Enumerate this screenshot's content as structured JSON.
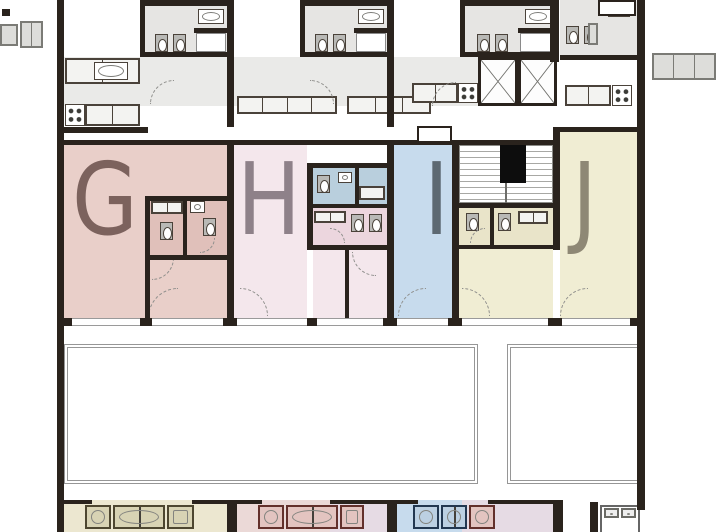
{
  "plan": {
    "kind": "apartment-floor-plan"
  },
  "units": [
    {
      "id": "g",
      "label": "G",
      "fill": "#e9cfc9",
      "bath_fill": "#e0c0ba",
      "letter_color": "#7c625d"
    },
    {
      "id": "h",
      "label": "H",
      "fill": "#f4e7ec",
      "bath_fill": "#ecd6de",
      "letter_color": "#8e8189"
    },
    {
      "id": "i",
      "label": "I",
      "fill": "#c7dbed",
      "bath_fill": "#b9cfdd",
      "letter_color": "#5d6972"
    },
    {
      "id": "j",
      "label": "J",
      "fill": "#f0edd3",
      "bath_fill": "#e9e4c9",
      "letter_color": "#8e8875"
    }
  ],
  "palette": {
    "wall": "#2a231d",
    "room_gray": "#e6e5e3",
    "corridor": "#eaeae8",
    "fixture_border": "#4a423a",
    "terrace_border": "#969696",
    "sill": "#9a9a9a",
    "bottom_cream": "#ece7d0",
    "bottom_pink": "#ebd9d7",
    "bottom_lavender": "#e6dbe4",
    "bottom_blue": "#c7dbed",
    "bottom_olive": "#4d4630",
    "bottom_maroon": "#63302b",
    "bottom_navy": "#223750"
  }
}
